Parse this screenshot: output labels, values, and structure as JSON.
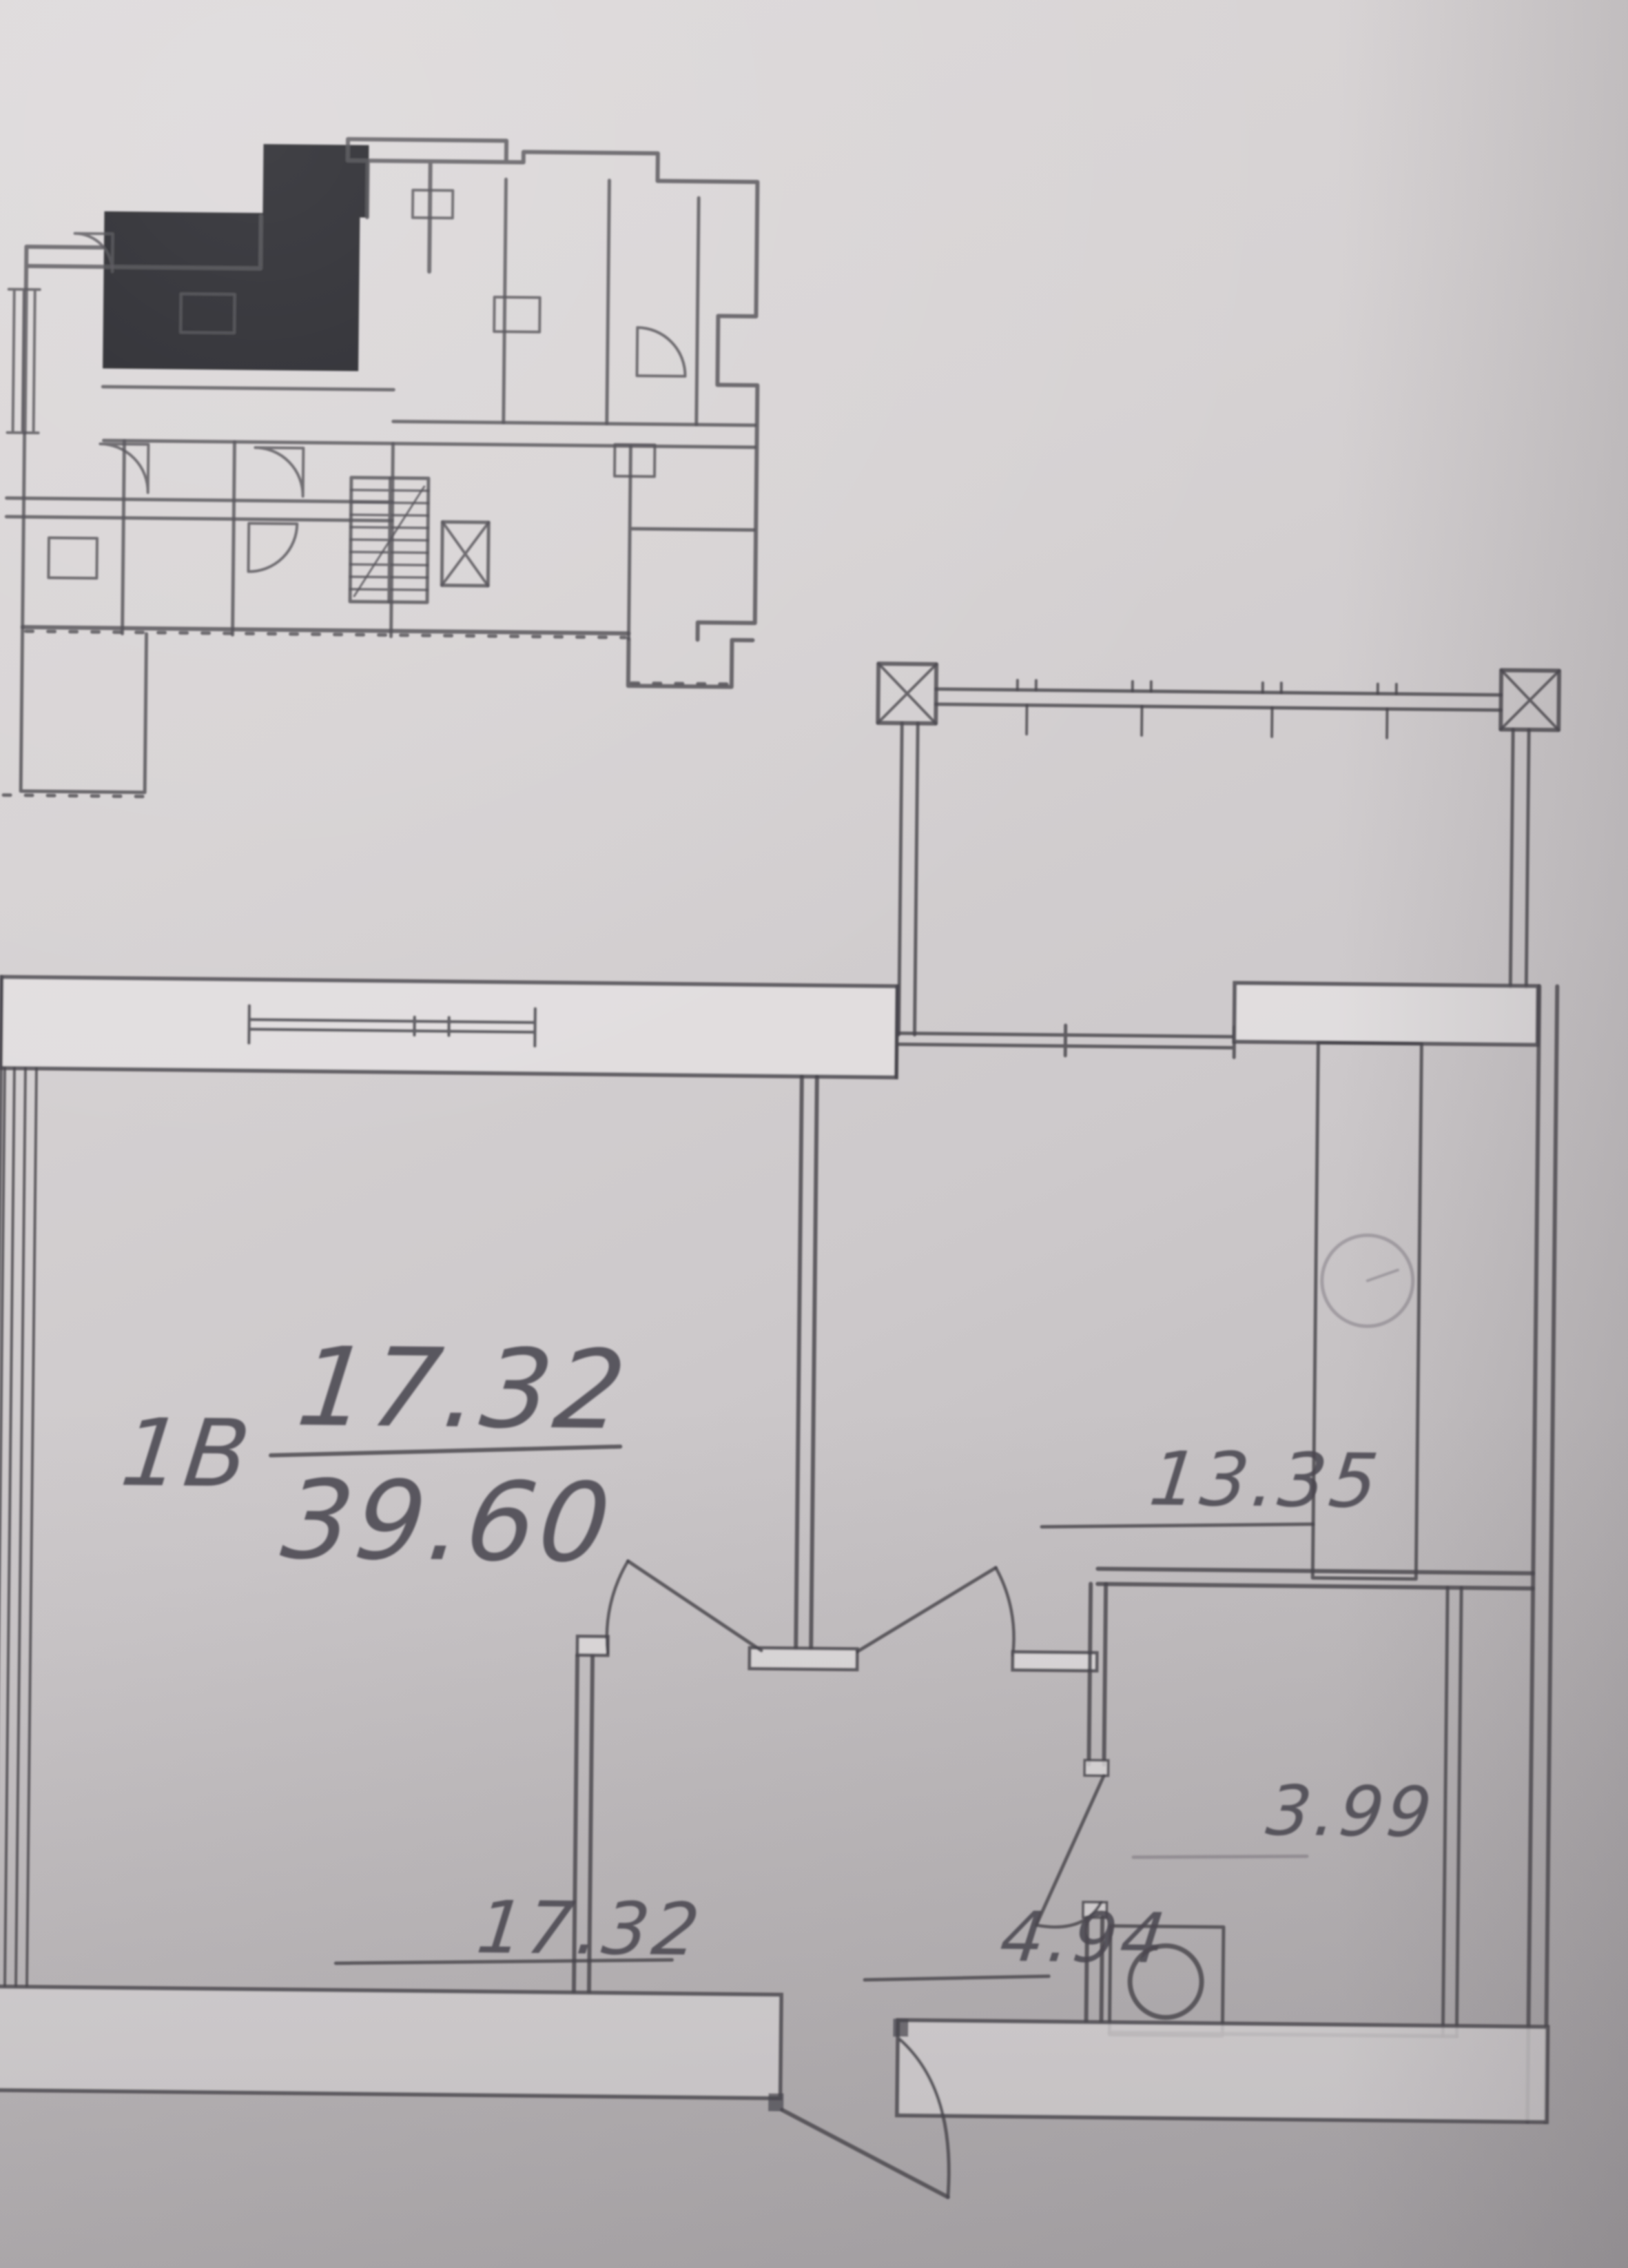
{
  "colors": {
    "paper": "#d6d2d3",
    "pencil_line": "#45434b",
    "highlight_unit_fill": "#1d1d20"
  },
  "overview_plan": {
    "description_label": "building-floor-overview",
    "highlighted_unit": "filled-black"
  },
  "apartment_plan": {
    "unit": {
      "type_label": "1В",
      "living_area": "17.32",
      "total_area": "39.60"
    },
    "rooms": [
      {
        "name": "living-room",
        "area": "17.32"
      },
      {
        "name": "kitchen",
        "area": "13.35"
      },
      {
        "name": "hallway",
        "area": "4.94"
      },
      {
        "name": "bathroom",
        "area": "3.99"
      }
    ],
    "labels": {
      "unit_type": "1В",
      "total_numerator": "17.32",
      "total_denominator": "39.60",
      "kitchen_area": "13.35",
      "living_area": "17.32",
      "hallway_area": "4.94",
      "bathroom_area": "3.99"
    }
  }
}
